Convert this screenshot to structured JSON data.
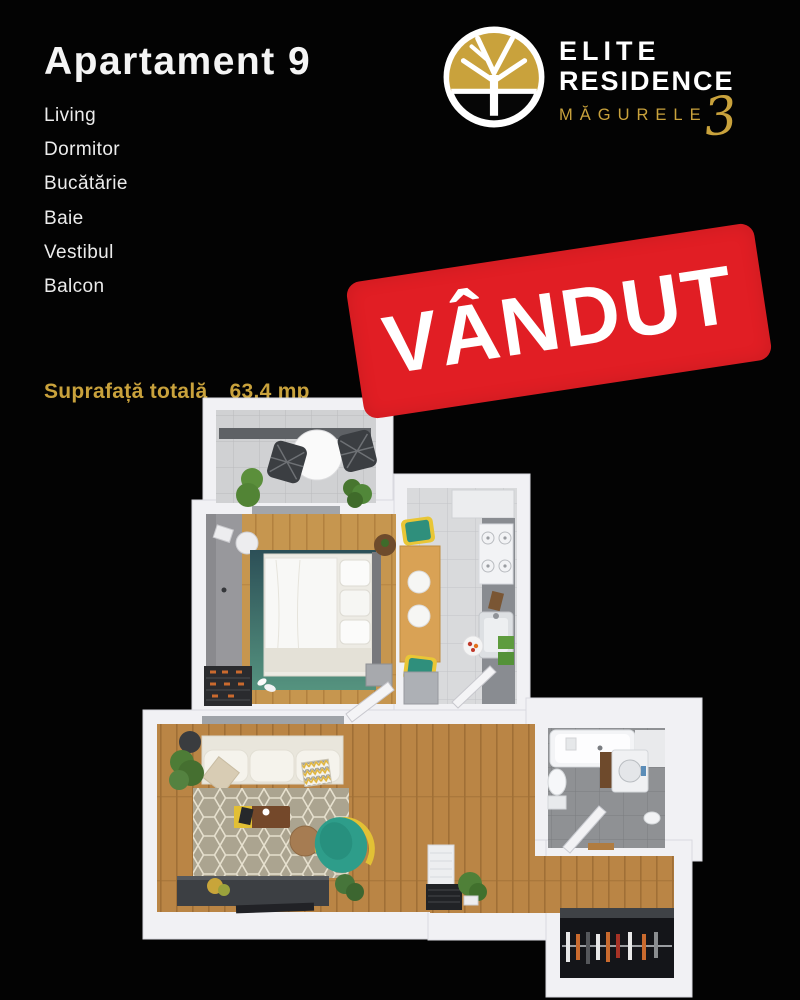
{
  "theme": {
    "background": "#030303",
    "text": "#F4F4F4",
    "gold": "#C9A23C",
    "red": "#E11E24"
  },
  "header": {
    "title": "Apartament 9",
    "rooms": [
      "Living",
      "Dormitor",
      "Bucătărie",
      "Baie",
      "Vestibul",
      "Balcon"
    ]
  },
  "logo": {
    "line1": "ELITE",
    "line2": "RESIDENCE",
    "line3": "MĂGURELE",
    "number": "3"
  },
  "sold_badge": {
    "label": "VÂNDUT",
    "bg": "#E11E24",
    "text_color": "#FFFFFF"
  },
  "area": {
    "label": "Suprafață totală",
    "value": "63.4 mp"
  },
  "floorplan": {
    "rooms": [
      "Balcon",
      "Dormitor",
      "Bucătărie",
      "Living",
      "Baie",
      "Vestibul"
    ],
    "colors": {
      "wall": "#F1F1F4",
      "wood_bedroom": "#C6964F",
      "wood_living": "#BA8545",
      "tile_balcony": "#D0D1D3",
      "tile_kitchen": "#D9DADC",
      "tile_bath": "#8F9194",
      "rug_bedroom_teal": "#3F7F78",
      "rug_living": "#ABA490",
      "armchair_teal": "#2E9D8A",
      "accent_yellow": "#E9C636",
      "console_dark": "#3C3F43",
      "wardrobe_dark": "#141519"
    }
  }
}
